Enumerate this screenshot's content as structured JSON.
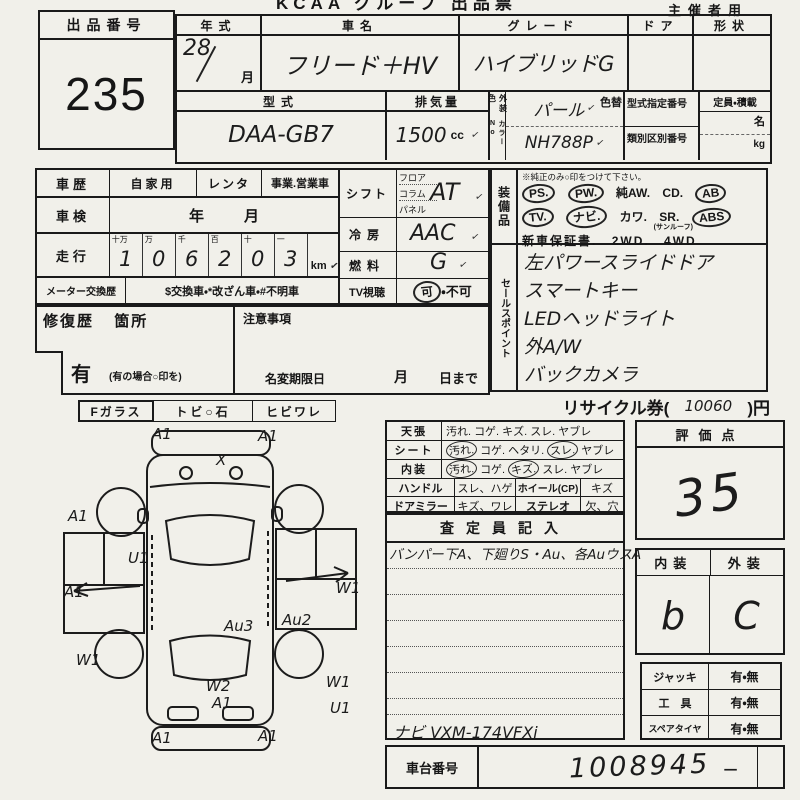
{
  "header": {
    "title": "KCAA グループ 出品票",
    "right_note": "主催者用"
  },
  "auction": {
    "label": "出品番号",
    "number": "235"
  },
  "top_table": {
    "year": {
      "header": "年式",
      "value": "28",
      "month": "月"
    },
    "name": {
      "header": "車名",
      "value": "フリード＋HV"
    },
    "grade": {
      "header": "グレード",
      "value": "ハイブリッドG"
    },
    "door": {
      "header": "ドア"
    },
    "shape": {
      "header": "形状"
    },
    "model": {
      "header": "型式",
      "value": "DAA-GB7"
    },
    "displacement": {
      "header": "排気量",
      "value": "1500",
      "unit": "cc"
    },
    "color": {
      "side_label": "外装色",
      "color_no_label": "カラーNo",
      "value": "パール",
      "color_no": "NH788P",
      "change_label": "色替"
    },
    "designation": {
      "top_label": "型式指定番号",
      "bottom_label": "類別区別番号"
    },
    "capacity": {
      "header": "定員・積載",
      "unit_top": "名",
      "unit_bottom": "kg"
    }
  },
  "history": {
    "car_history": {
      "label": "車歴",
      "options": [
        "自家用",
        "レンタ",
        "事業.営業車"
      ]
    },
    "inspection": {
      "label": "車検",
      "year": "年",
      "month": "月"
    },
    "mileage": {
      "label": "走行",
      "digit_headers": [
        "十万",
        "万",
        "千",
        "百",
        "十",
        "一"
      ],
      "digits": [
        "1",
        "0",
        "6",
        "2",
        "0",
        "3"
      ],
      "unit": "km"
    },
    "meter": {
      "label": "メーター交換歴",
      "note": "$交換車・*改ざん車・#不明車"
    }
  },
  "controls": {
    "shift": {
      "label": "シフト",
      "options": [
        "フロア",
        "コラム",
        "パネル"
      ],
      "value": "AT"
    },
    "ac": {
      "label": "冷房",
      "value": "AAC"
    },
    "fuel": {
      "label": "燃料",
      "value": "G"
    },
    "tv": {
      "label": "TV視聴",
      "ok": "可",
      "sep": "・",
      "ng": "不可"
    }
  },
  "repair": {
    "label": "修復歴",
    "sub": "箇所",
    "has": "有",
    "note": "(有の場合○印を)"
  },
  "notes": {
    "label": "注意事項",
    "name_change": "名変期限日",
    "month": "月",
    "day": "日まで"
  },
  "equipment": {
    "label": "装備品",
    "note": "※純正のみ○印をつけて下さい。",
    "rows": [
      {
        "items": [
          {
            "label": "PS.",
            "circled": true
          },
          {
            "label": "PW.",
            "circled": true
          },
          {
            "label": "純AW.",
            "circled": false
          },
          {
            "label": "CD.",
            "circled": false
          },
          {
            "label": "AB",
            "circled": true,
            "note": "(ｴｱﾊﾞｯｸﾞ)"
          }
        ]
      },
      {
        "items": [
          {
            "label": "TV.",
            "circled": true
          },
          {
            "label": "ナビ.",
            "circled": true
          },
          {
            "label": "カワ.",
            "circled": false
          },
          {
            "label": "SR.",
            "circled": false,
            "note": "(サンルーフ)"
          },
          {
            "label": "ABS",
            "circled": true
          }
        ]
      },
      {
        "items": [
          {
            "label": "新車保証書.",
            "circled": false
          },
          {
            "label": "2WD.",
            "circled": false
          },
          {
            "label": "4WD",
            "circled": false
          }
        ]
      }
    ]
  },
  "sales": {
    "label": "セールスポイント",
    "items": [
      "左パワースライドドア",
      "スマートキー",
      "LEDヘッドライト",
      "外A/W",
      "バックカメラ"
    ]
  },
  "recycle": {
    "prefix": "リサイクル券(",
    "value": "10060",
    "suffix": ")円"
  },
  "condition": {
    "rows": [
      {
        "label": "天張",
        "options": [
          {
            "t": "汚れ.",
            "circled": false
          },
          {
            "t": "コゲ.",
            "circled": false
          },
          {
            "t": "キズ.",
            "circled": false
          },
          {
            "t": "スレ.",
            "circled": false
          },
          {
            "t": "ヤブレ",
            "circled": false
          }
        ]
      },
      {
        "label": "シート",
        "options": [
          {
            "t": "汚れ.",
            "circled": true
          },
          {
            "t": "コゲ.",
            "circled": false
          },
          {
            "t": "ヘタリ.",
            "circled": false
          },
          {
            "t": "スレ.",
            "circled": true
          },
          {
            "t": "ヤブレ",
            "circled": false
          }
        ]
      },
      {
        "label": "内装",
        "options": [
          {
            "t": "汚れ.",
            "circled": true
          },
          {
            "t": "コゲ.",
            "circled": false
          },
          {
            "t": "キズ.",
            "circled": true
          },
          {
            "t": "スレ.",
            "circled": false
          },
          {
            "t": "ヤブレ",
            "circled": false
          }
        ]
      }
    ],
    "rows2": [
      {
        "label": "ハンドル",
        "opt1": "スレ、ハゲ",
        "label2": "ホイール(CP)",
        "opt2": "キズ"
      },
      {
        "label": "ドアミラー",
        "opt1": "キズ、ワレ",
        "label2": "ステレオ",
        "opt2": "欠、穴"
      }
    ]
  },
  "score": {
    "label": "評価点",
    "value": "35"
  },
  "interior_exterior": {
    "i_label": "内装",
    "e_label": "外装",
    "i_value": "b",
    "e_value": "C"
  },
  "accessories": {
    "rows": [
      {
        "label": "ジャッキ",
        "value": "有・無"
      },
      {
        "label": "工　具",
        "value": "有・無"
      },
      {
        "label": "スペアタイヤ",
        "value": "有・無"
      }
    ]
  },
  "assessor": {
    "header": "査定員記入",
    "line1": "バンパー下A、下廻りS・Au、各AuウスA",
    "nav": "ナビ VXM-174VFXi"
  },
  "chassis": {
    "label": "車台番号",
    "value": "1008945",
    "dash": "−"
  },
  "glass": {
    "items": [
      "Fガラス",
      "トビ○石",
      "ヒビワレ"
    ]
  },
  "marks": {
    "tick": "✓",
    "x_mark": "X"
  },
  "diagram": {
    "marks": [
      {
        "label": "A1"
      },
      {
        "label": "A1"
      },
      {
        "label": "X"
      },
      {
        "label": "A1"
      },
      {
        "label": "U1"
      },
      {
        "label": "A1"
      },
      {
        "label": "W1"
      },
      {
        "label": "Au2"
      },
      {
        "label": "Au3"
      },
      {
        "label": "W1"
      },
      {
        "label": "W2"
      },
      {
        "label": "A1"
      },
      {
        "label": "W1"
      },
      {
        "label": "U1"
      },
      {
        "label": "A1"
      },
      {
        "label": "A1"
      }
    ]
  }
}
